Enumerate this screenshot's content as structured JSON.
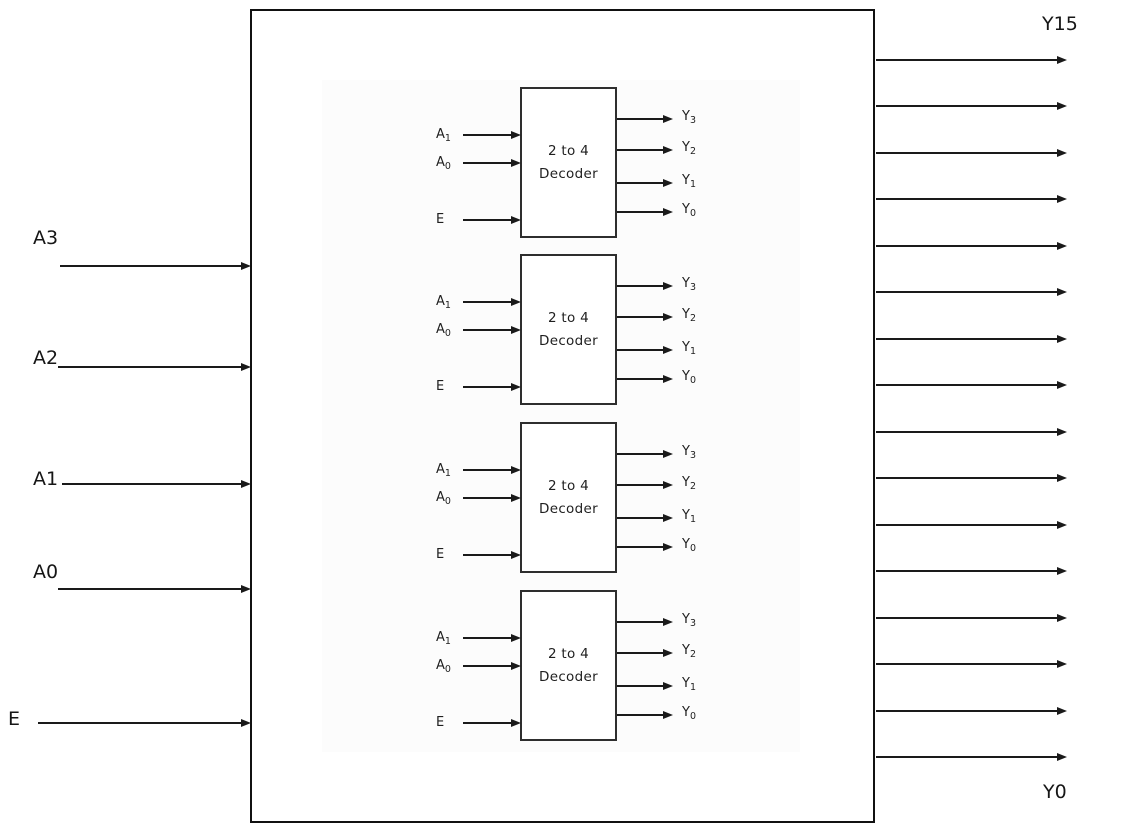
{
  "external_inputs": [
    {
      "label": "A3"
    },
    {
      "label": "A2"
    },
    {
      "label": "A1"
    },
    {
      "label": "A0"
    },
    {
      "label": "E"
    }
  ],
  "external_outputs": {
    "count": 16,
    "top_label": "Y15",
    "bottom_label": "Y0"
  },
  "decoder_blocks": {
    "count": 4,
    "title_line1": "2 to 4",
    "title_line2": "Decoder",
    "inputs": [
      {
        "base": "A",
        "sub": "1"
      },
      {
        "base": "A",
        "sub": "0"
      },
      {
        "base": "E",
        "sub": ""
      }
    ],
    "outputs": [
      {
        "base": "Y",
        "sub": "3"
      },
      {
        "base": "Y",
        "sub": "2"
      },
      {
        "base": "Y",
        "sub": "1"
      },
      {
        "base": "Y",
        "sub": "0"
      }
    ]
  },
  "colors": {
    "line": "#1a1a1a",
    "text": "#1f1f1f",
    "outer_border": "#111111",
    "decoder_border": "#2e2e2e",
    "background": "#ffffff",
    "inner_panel": "#fcfcfc"
  }
}
